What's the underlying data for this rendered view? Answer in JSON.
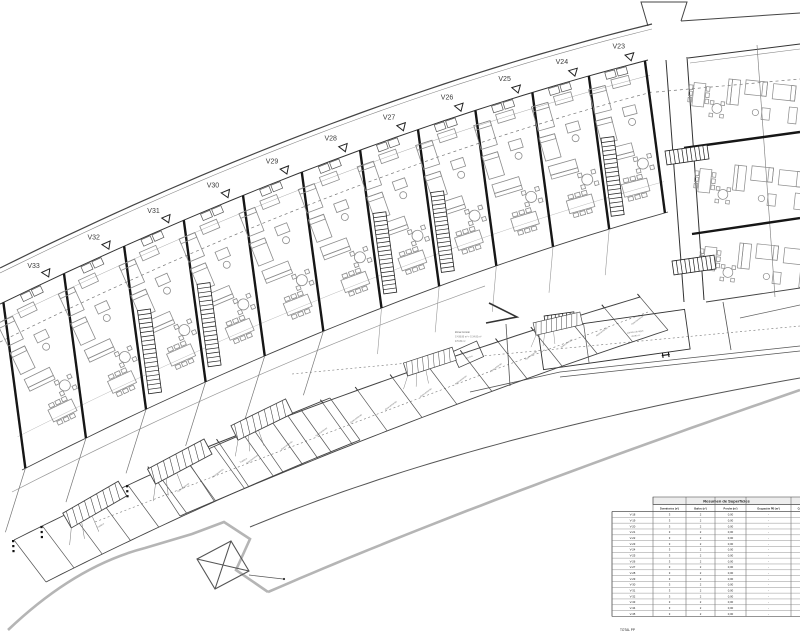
{
  "page": {
    "background": "#ffffff"
  },
  "drawing": {
    "unit_labels": [
      "V33",
      "V32",
      "V31",
      "V30",
      "V29",
      "V28",
      "V27",
      "V26",
      "V25",
      "V24",
      "V23"
    ],
    "annotations": {
      "zona_comun": [
        "Zona Común",
        "S 436.80 m² + S 34.00 m²",
        "470.80 m²"
      ],
      "lamina_agua": [
        "Lámina de agua",
        "49.80 m²"
      ],
      "inst_piscina": [
        "Inst. /",
        "Piscina"
      ],
      "parking_label": "Aparcamiento",
      "storage_label": "Trastero"
    },
    "colors": {
      "line": "#2b2b2b",
      "furniture": "#8c8c8c",
      "boundary": "#b5b5b5",
      "dashed": "#777777"
    }
  },
  "table": {
    "title": "Resumen de Superficies",
    "columns": [
      "Dormitorios (nº)",
      "Baños (nº)",
      "Porche (m²)",
      "Ocupación PB (m²)",
      "Const."
    ],
    "rows": [
      {
        "id": "V-18",
        "values": [
          "3",
          "2",
          "0,00",
          "-"
        ]
      },
      {
        "id": "V-19",
        "values": [
          "3",
          "2",
          "0,00",
          "-"
        ]
      },
      {
        "id": "V-20",
        "values": [
          "3",
          "2",
          "0,00",
          "-"
        ]
      },
      {
        "id": "V-21",
        "values": [
          "3",
          "2",
          "0,00",
          "-"
        ]
      },
      {
        "id": "V-22",
        "values": [
          "3",
          "2",
          "0,00",
          "-"
        ]
      },
      {
        "id": "V-23",
        "values": [
          "3",
          "2",
          "0,00",
          "-"
        ]
      },
      {
        "id": "V-24",
        "values": [
          "3",
          "2",
          "0,00",
          "-"
        ]
      },
      {
        "id": "V-25",
        "values": [
          "3",
          "2",
          "0,00",
          "-"
        ]
      },
      {
        "id": "V-26",
        "values": [
          "3",
          "2",
          "0,00",
          "-"
        ]
      },
      {
        "id": "V-27",
        "values": [
          "3",
          "2",
          "0,00",
          "-"
        ]
      },
      {
        "id": "V-28",
        "values": [
          "3",
          "2",
          "0,00",
          "-"
        ]
      },
      {
        "id": "V-29",
        "values": [
          "3",
          "2",
          "0,00",
          "-"
        ]
      },
      {
        "id": "V-30",
        "values": [
          "3",
          "2",
          "0,00",
          "-"
        ]
      },
      {
        "id": "V-31",
        "values": [
          "3",
          "2",
          "0,00",
          "-"
        ]
      },
      {
        "id": "V-32",
        "values": [
          "3",
          "2",
          "0,00",
          "-"
        ]
      },
      {
        "id": "V-33",
        "values": [
          "3",
          "2",
          "0,00",
          "-"
        ]
      },
      {
        "id": "V-34",
        "values": [
          "3",
          "2",
          "0,00",
          "-"
        ]
      },
      {
        "id": "V-35",
        "values": [
          "3",
          "2",
          "0,00",
          "-"
        ]
      }
    ],
    "footer": "TOTAL PP"
  }
}
